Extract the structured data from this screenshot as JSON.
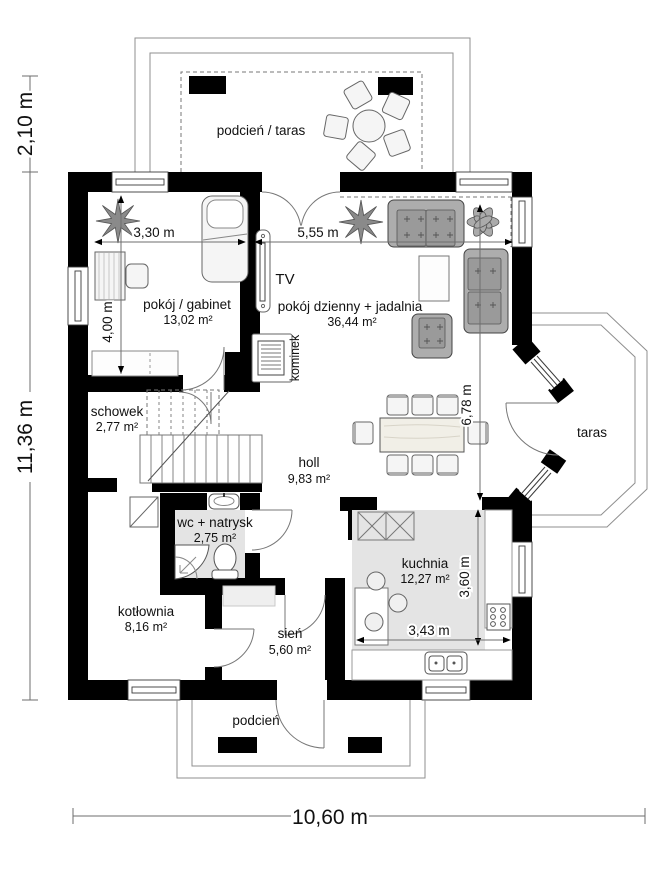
{
  "plan": {
    "type": "floor-plan",
    "rooms": {
      "taras_gorny": {
        "label": "podcień / taras"
      },
      "gabinet": {
        "label": "pokój / gabinet",
        "area": "13,02 m²"
      },
      "salon": {
        "label": "pokój dzienny + jadalnia",
        "area": "36,44 m²"
      },
      "schowek": {
        "label": "schowek",
        "area": "2,77 m²"
      },
      "holl": {
        "label": "holl",
        "area": "9,83 m²"
      },
      "wc": {
        "label": "wc + natrysk",
        "area": "2,75 m²"
      },
      "kotlownia": {
        "label": "kotłownia",
        "area": "8,16 m²"
      },
      "sien": {
        "label": "sień",
        "area": "5,60 m²"
      },
      "kuchnia": {
        "label": "kuchnia",
        "area": "12,27 m²"
      },
      "taras_boczny": {
        "label": "taras"
      },
      "podcien_dolny": {
        "label": "podcień"
      }
    },
    "annotations": {
      "tv": "TV",
      "kominek": "kominek"
    },
    "dimensions": {
      "taras_depth": "2,10 m",
      "house_depth": "11,36 m",
      "house_width": "10,60 m",
      "gabinet_width": "3,30 m",
      "gabinet_depth": "4,00 m",
      "salon_width": "5,55 m",
      "salon_depth": "6,78 m",
      "kuchnia_depth": "3,60 m",
      "kuchnia_width": "3,43 m"
    },
    "colors": {
      "wall": "#000000",
      "outline": "#8f8f8f",
      "floor_shade": "#e4e4e4",
      "furniture": "#adadad"
    }
  }
}
